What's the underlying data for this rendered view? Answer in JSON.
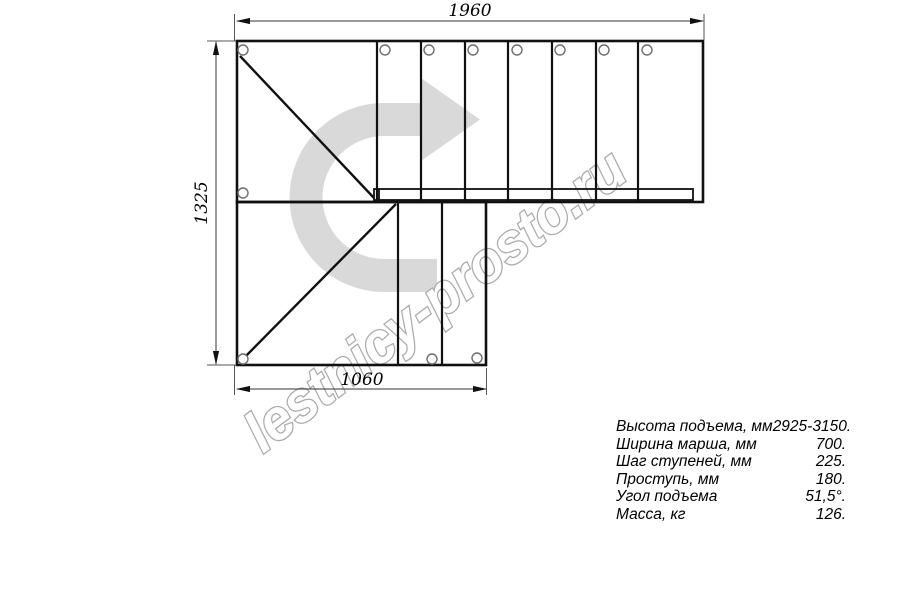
{
  "watermark": {
    "text": "lestnicy-prosto.ru",
    "outline_color": "#ababab"
  },
  "drawing": {
    "type": "staircase-plan-top-view",
    "dimensions": {
      "top_width_mm": "1960",
      "left_height_mm": "1325",
      "bottom_width_mm": "1060"
    },
    "direction_arrow_color": "#d9d9d9",
    "line_color": "#111111"
  },
  "specs": {
    "rows": [
      {
        "label": "Высота подъема, мм",
        "value": "2925-3150."
      },
      {
        "label": "Ширина марша, мм",
        "value": "700."
      },
      {
        "label": "Шаг ступеней, мм",
        "value": "225."
      },
      {
        "label": "Проступь, мм",
        "value": "180."
      },
      {
        "label": "Угол подъема",
        "value": "51,5°."
      },
      {
        "label": "Масса, кг",
        "value": "126."
      }
    ]
  }
}
